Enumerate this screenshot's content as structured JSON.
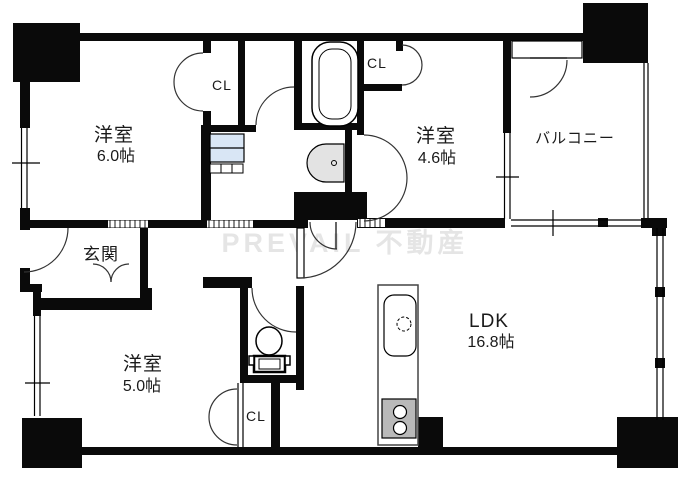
{
  "floorplan": {
    "watermark": "PREVAIL 不動産",
    "rooms": {
      "bedroom_top_left": {
        "name": "洋室",
        "size": "6.0帖"
      },
      "bedroom_top_right": {
        "name": "洋室",
        "size": "4.6帖"
      },
      "bedroom_bottom_left": {
        "name": "洋室",
        "size": "5.0帖"
      },
      "ldk": {
        "name": "LDK",
        "size": "16.8帖"
      },
      "balcony": {
        "name": "バルコニー"
      },
      "entrance": {
        "name": "玄関"
      },
      "closet_top_left": {
        "label": "CL"
      },
      "closet_top_right": {
        "label": "CL"
      },
      "closet_bottom": {
        "label": "CL"
      }
    },
    "colors": {
      "wall": "#0a0a0a",
      "washer_pan": "#d9e6f5",
      "stove_gray": "#b9b9b9",
      "basin_gray": "#e3e3e3"
    }
  }
}
